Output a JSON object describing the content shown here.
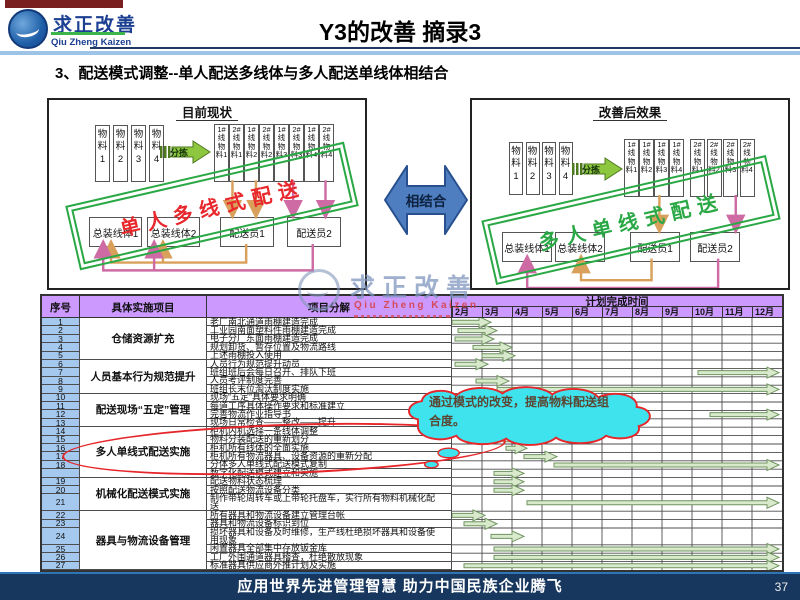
{
  "header": {
    "brand": "求正改善",
    "brand_en": "Qiu Zheng Kaizen",
    "title": "Y3的改善  摘录3"
  },
  "subtitle": "3、配送模式调整--单人配送多线体与多人配送单线体相结合",
  "diagram": {
    "left": {
      "title": "目前现状",
      "materials": [
        "物料1",
        "物料2",
        "物料3",
        "物料4"
      ],
      "sort_label": "分拣",
      "line_boxes": [
        "1#线物料1",
        "2#线物料1",
        "1#线物料2",
        "2#线物料2",
        "1#线物料3",
        "2#线物料3",
        "1#线物料4",
        "2#线物料4"
      ],
      "stations": [
        "总装线体1",
        "总装线体2"
      ],
      "couriers": [
        "配送员1",
        "配送员2"
      ],
      "stamp": "单人多线式配送",
      "stamp_color": "#e8282c"
    },
    "right": {
      "title": "改善后效果",
      "materials": [
        "物料1",
        "物料2",
        "物料3",
        "物料4"
      ],
      "sort_label": "分拣",
      "line_boxes_1": [
        "1#线物料1",
        "1#线物料2",
        "1#线物料3",
        "1#线物料4"
      ],
      "line_boxes_2": [
        "2#线物料1",
        "2#线物料2",
        "2#线物料3",
        "2#线物料4"
      ],
      "stations": [
        "总装线体1",
        "总装线体2"
      ],
      "couriers": [
        "配送员1",
        "配送员2"
      ],
      "stamp": "多人单线式配送",
      "stamp_color": "#2aa845"
    },
    "combine_label": "相结合"
  },
  "callout": {
    "text": "通过模式的改变，提高物料配送组合度。"
  },
  "watermark": {
    "text": "求正改善",
    "sub": "Qiu Zheng Kaizen"
  },
  "table": {
    "headers": {
      "no": "序号",
      "group": "具体实施项目",
      "item": "项目分解",
      "plan": "计划完成时间"
    },
    "months": [
      "2月",
      "3月",
      "4月",
      "5月",
      "6月",
      "7月",
      "8月",
      "9月",
      "10月",
      "11月",
      "12月"
    ],
    "groups": [
      {
        "label": "仓储资源扩充",
        "start": 0,
        "rows": 5
      },
      {
        "label": "人员基本行为规范提升",
        "start": 5,
        "rows": 4
      },
      {
        "label": "配送现场“五定”管理",
        "start": 9,
        "rows": 4
      },
      {
        "label": "多人单线式配送实施",
        "start": 13,
        "rows": 6
      },
      {
        "label": "机械化配送模式实施",
        "start": 19,
        "rows": 3
      },
      {
        "label": "器具与物流设备管理",
        "start": 22,
        "rows": 6
      }
    ],
    "rows": [
      {
        "no": "1",
        "item": "老厂南北通道雨棚建造完成",
        "units": 1,
        "bar": [
          2.0,
          3.3
        ]
      },
      {
        "no": "2",
        "item": "工业园南面塑料件雨棚建造完成",
        "units": 1,
        "bar": [
          2.2,
          3.5
        ]
      },
      {
        "no": "3",
        "item": "电子分厂东面雨棚建造完成",
        "units": 1,
        "bar": [
          2.1,
          3.4
        ]
      },
      {
        "no": "4",
        "item": "规划卸货、暂存位置及物流路线",
        "units": 1,
        "bar": [
          2.7,
          4.0
        ]
      },
      {
        "no": "5",
        "item": "上述雨棚投入使用",
        "units": 1,
        "bar": [
          3.0,
          4.1
        ]
      },
      {
        "no": "6",
        "item": "人员行为规范提升动员",
        "units": 1,
        "bar": [
          2.1,
          3.2
        ]
      },
      {
        "no": "7",
        "item": "班组班后会每日召开、排队下班",
        "units": 1,
        "bar": [
          10.2,
          12.9
        ]
      },
      {
        "no": "8",
        "item": "人员考评制度完善",
        "units": 1,
        "bar": [
          2.8,
          3.9
        ]
      },
      {
        "no": "9",
        "item": "班组长末位淘汰制度实施",
        "units": 1,
        "bar": [
          3.5,
          12.9
        ]
      },
      {
        "no": "10",
        "item": "现场“五定”具体要求明确",
        "units": 1,
        "bar": null
      },
      {
        "no": "11",
        "item": "每道工序具体操作要求和标准建立",
        "units": 1,
        "bar": null
      },
      {
        "no": "12",
        "item": "完善物流作业指导书",
        "units": 1,
        "bar": [
          10.6,
          12.9
        ]
      },
      {
        "no": "13",
        "item": "现场日常检查——整改——提升",
        "units": 1,
        "bar": null
      },
      {
        "no": "14",
        "item": "柜机内机选择一条线体调整",
        "units": 1,
        "bar": [
          2.4,
          3.5
        ]
      },
      {
        "no": "15",
        "item": "物料分装配送的重新划分",
        "units": 1,
        "bar": [
          3.7,
          4.5
        ]
      },
      {
        "no": "16",
        "item": "柜机所有线体的全面实施",
        "units": 1,
        "bar": [
          3.8,
          4.5
        ]
      },
      {
        "no": "17",
        "item": "柜机所有物流器具、设备资源的重新分配",
        "units": 1,
        "bar": [
          4.4,
          5.5
        ]
      },
      {
        "no": "18",
        "item": "分体多人单线式配送模式复制",
        "units": 1,
        "bar": [
          5.4,
          12.9
        ]
      },
      {
        "no": "",
        "item": "数字化配送模式建立和实施",
        "units": 1,
        "bar": [
          3.4,
          4.4
        ]
      },
      {
        "no": "19",
        "item": "配送物料状态梳理",
        "units": 1,
        "bar": [
          3.4,
          4.4
        ]
      },
      {
        "no": "20",
        "item": "按照配送物流设备分类",
        "units": 1,
        "bar": [
          3.4,
          4.4
        ]
      },
      {
        "no": "21",
        "item": "制作带轮周转车或上带轮托盘车，实行所有物料机械化配送",
        "units": 2,
        "bar": [
          4.5,
          12.9
        ]
      },
      {
        "no": "22",
        "item": "所有器具和物流设备建立管理台帐",
        "units": 1,
        "bar": [
          2.0,
          3.1
        ]
      },
      {
        "no": "23",
        "item": "器具和物流设备标识到位",
        "units": 1,
        "bar": [
          2.4,
          3.5
        ]
      },
      {
        "no": "24",
        "item": "损坏器具和设备及时维修，生产线杜绝损坏器具和设备使用现象",
        "units": 2,
        "bar": [
          3.3,
          4.4
        ]
      },
      {
        "no": "25",
        "item": "闲置器具全部集中存放钣金库",
        "units": 1,
        "bar": [
          3.4,
          12.9
        ]
      },
      {
        "no": "26",
        "item": "工厂外围通道器具稽查，杜绝散放现象",
        "units": 1,
        "bar": [
          3.4,
          12.9
        ]
      },
      {
        "no": "27",
        "item": "标准器具供应商外推计划及实施",
        "units": 1,
        "bar": [
          2.4,
          12.9
        ]
      }
    ]
  },
  "footer": {
    "slogan": "应用世界先进管理智慧  助力中国民族企业腾飞",
    "page": "37"
  }
}
